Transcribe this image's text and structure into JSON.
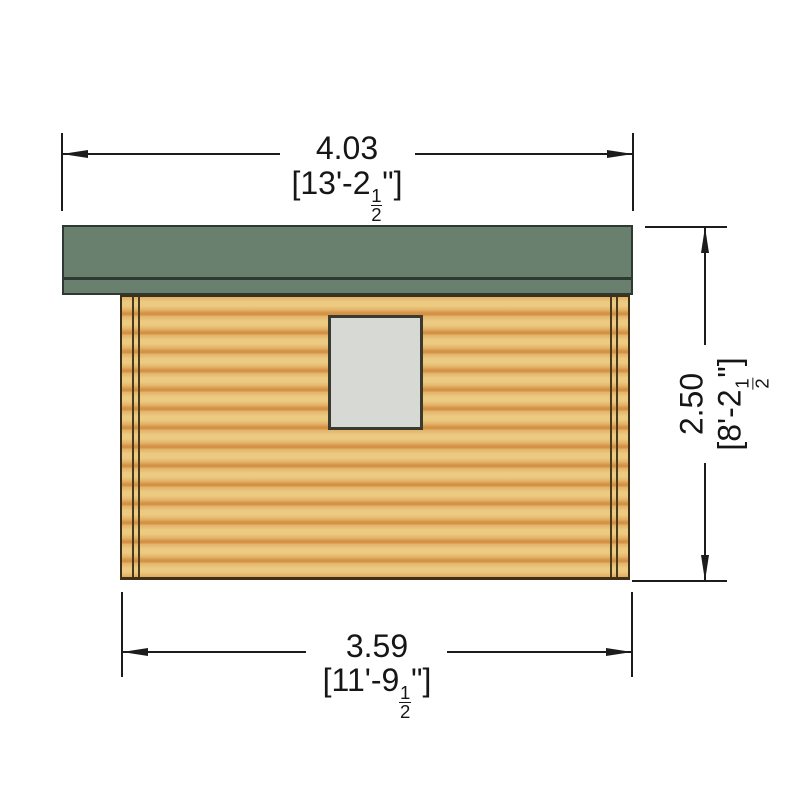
{
  "colors": {
    "line": "#1c1c1c",
    "text": "#161616",
    "roof-fill": "#69806f",
    "roof-edge": "#2e3a31",
    "wood-light": "#ecca81",
    "wood-mid": "#e2b268",
    "wood-dark": "#d49247",
    "wall-edge": "#3f3016",
    "corner-line": "#4a3a1c",
    "window-fill": "#d7d9d5",
    "window-edge": "#3a3a30"
  },
  "dimensions": {
    "top": {
      "metric": "4.03",
      "imperial_prefix": "[13'-2",
      "fraction_numerator": "1",
      "fraction_denominator": "2",
      "imperial_suffix": "\"]"
    },
    "bottom": {
      "metric": "3.59",
      "imperial_prefix": "[11'-9",
      "fraction_numerator": "1",
      "fraction_denominator": "2",
      "imperial_suffix": "\"]"
    },
    "right": {
      "metric": "2.50",
      "imperial_prefix": "[8'-2",
      "fraction_numerator": "1",
      "fraction_denominator": "2",
      "imperial_suffix": "\"]"
    }
  }
}
